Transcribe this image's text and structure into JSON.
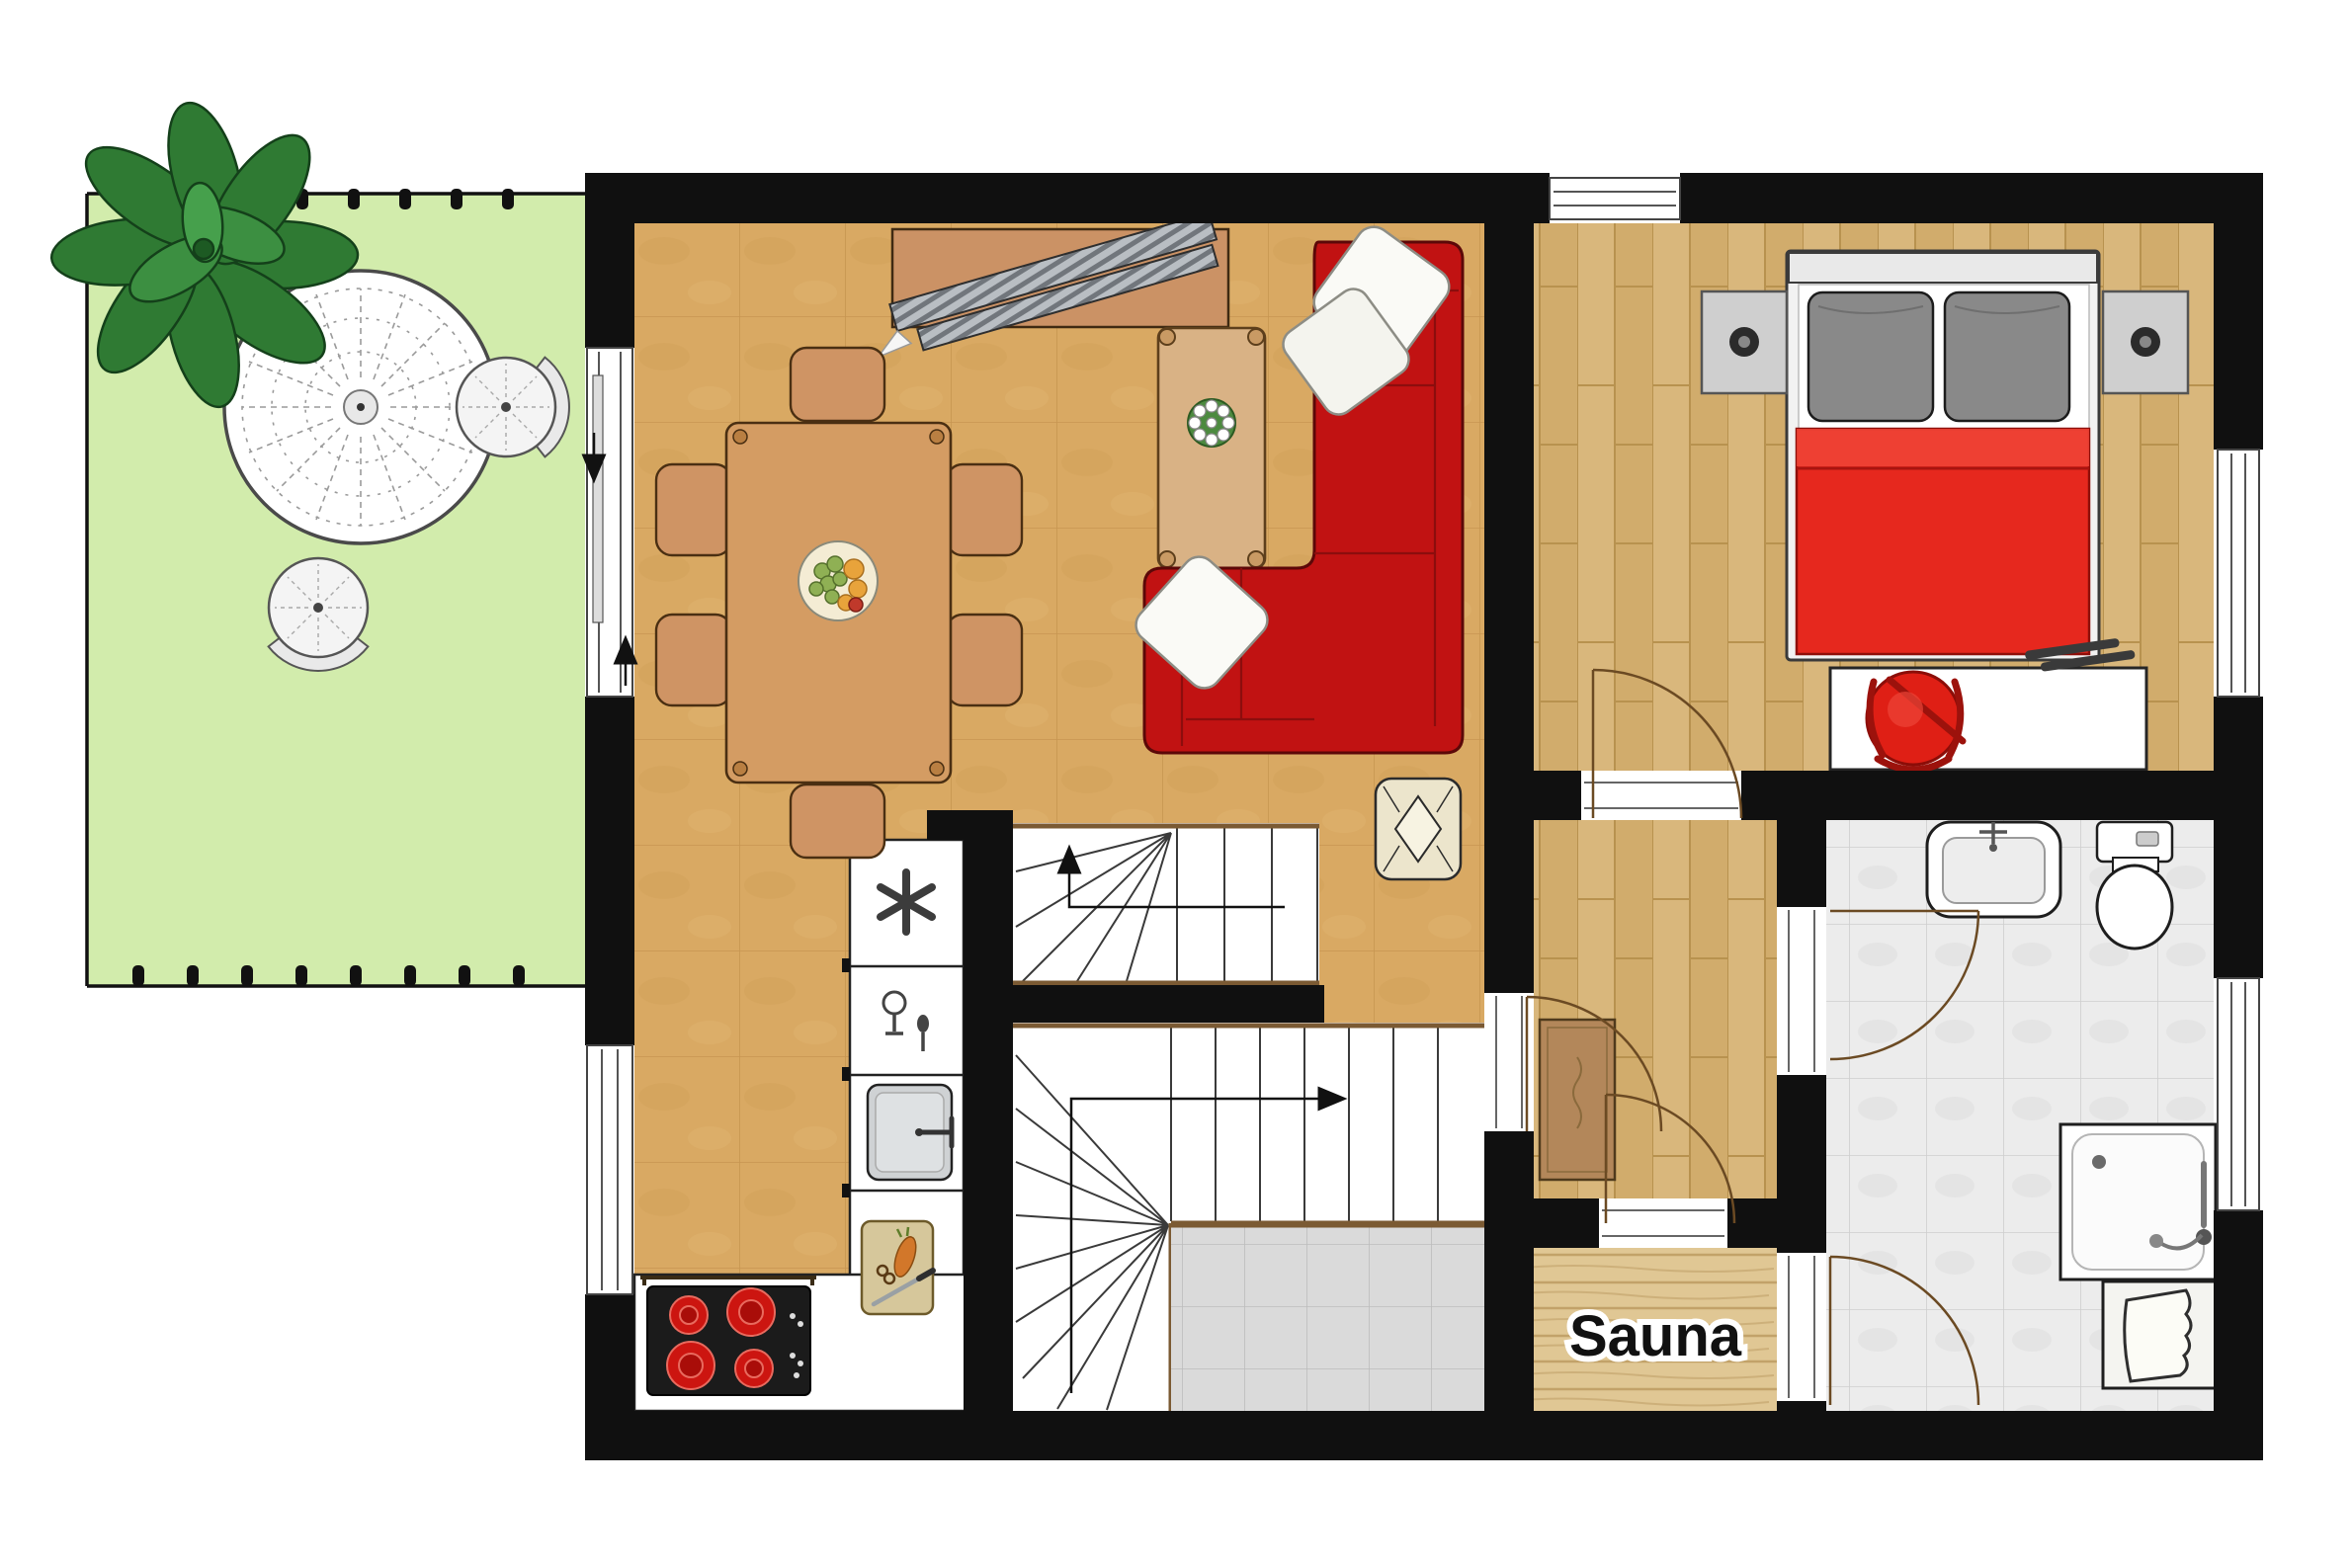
{
  "labels": {
    "sauna": "Sauna"
  },
  "colors": {
    "wall": "#101010",
    "terrace_green": "#d2ecac",
    "living_floor_tan": "#d9a963",
    "plank_wood": "#d8b679",
    "sauna_wood": "#e0c794",
    "bath_tile_gray": "#ececec",
    "landing_tile_gray": "#d9d9d9",
    "sofa_red": "#c11212",
    "bed_red": "#e6281e",
    "furniture_wood": "#cf9464",
    "door_arc_brown": "#6b4a23"
  },
  "icons": {
    "plant": "potted-plant-icon",
    "patio_table": "lace-round-table-icon",
    "freezer": "snowflake-icon",
    "dishwasher": "glass-and-spoon-icon",
    "kitchen_sink": "sink-basin-icon",
    "stove": "four-burner-cooktop-icon",
    "cutting_board": "cutting-board-knife-icon",
    "tv": "flatscreen-tv-icon",
    "fruit_bowl": "fruit-bowl-icon",
    "flowers": "flower-centerpiece-icon",
    "washbasin": "washbasin-icon",
    "toilet": "toilet-icon",
    "shower": "shower-icon",
    "laundry_basket": "laundry-basket-icon",
    "doormat": "doormat-icon",
    "stairs_up_arrow": "up-arrow-icon",
    "stairs_direction_arrow": "right-arrow-icon"
  }
}
